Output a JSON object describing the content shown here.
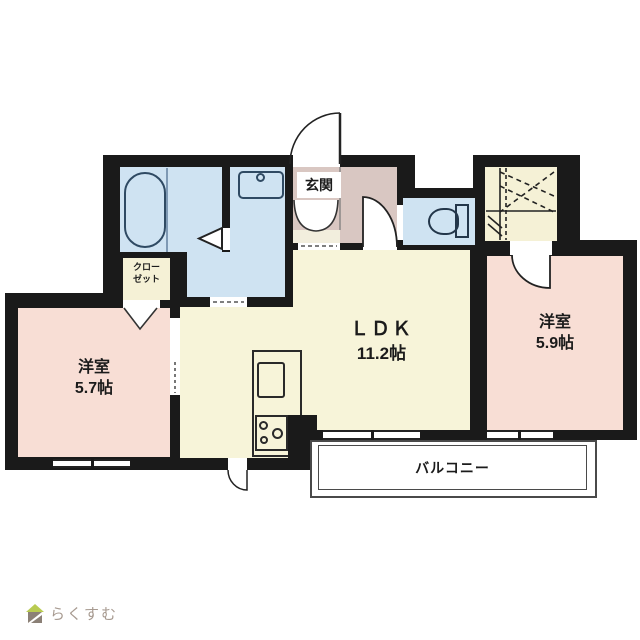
{
  "floorplan": {
    "rooms": {
      "ldk": {
        "label": "ＬＤＫ",
        "area": "11.2帖"
      },
      "bedroom_a": {
        "label": "洋室",
        "area": "5.7帖"
      },
      "bedroom_b": {
        "label": "洋室",
        "area": "5.9帖"
      },
      "entrance": {
        "label": "玄関"
      },
      "closet": {
        "label_line1": "クロー",
        "label_line2": "ゼット"
      },
      "balcony": {
        "label": "バルコニー"
      }
    },
    "fixtures": [
      "bathtub",
      "washbasin",
      "toilet",
      "kitchen-sink",
      "stove"
    ],
    "colors": {
      "wall": "#1a1a1a",
      "wet_rooms": "#cfe3f2",
      "bedrooms": "#f8ded5",
      "ldk": "#f7f4d9",
      "entrance_hall": "#d9c7c2",
      "closets": "#f5f1d6"
    }
  },
  "branding": {
    "logo_text": "らくすむ"
  }
}
